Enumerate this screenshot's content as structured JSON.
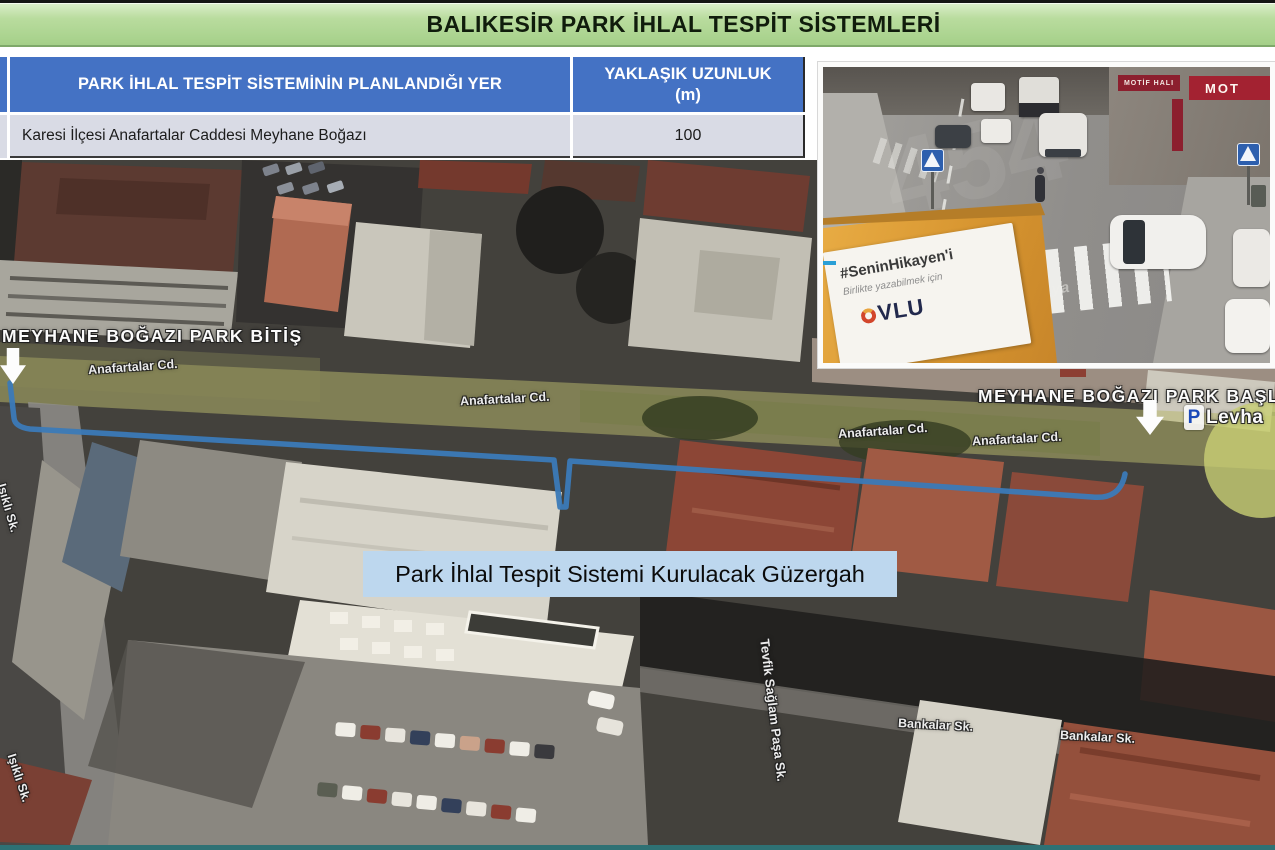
{
  "header": {
    "title": "BALIKESİR PARK İHLAL TESPİT SİSTEMLERİ"
  },
  "table": {
    "col1_header": "PARK İHLAL TESPİT SİSTEMİNİN PLANLANDIĞI YER",
    "col2_header_line1": "YAKLAŞIK UZUNLUK",
    "col2_header_line2": "(m)",
    "rows": [
      {
        "location": "Karesi İlçesi Anafartalar Caddesi Meyhane Boğazı",
        "length": "100"
      }
    ]
  },
  "camera_photo": {
    "banner_hashtag": "#SeninHikayen'i",
    "banner_tagline": "Birlikte yazabilmek için",
    "banner_logo": "VLU",
    "shop_sign_small": "MOTİF HALI",
    "shop_sign_large": "MOT",
    "road_marking": "yaya",
    "watermark": "454"
  },
  "map": {
    "label_park_end": "MEYHANE BOĞAZI PARK BİTİŞ",
    "label_park_start": "MEYHANE BOĞAZI PARK BAŞLAN",
    "label_levha": "Levha",
    "label_levha_icon": "P",
    "route_label": "Park İhlal Tespit Sistemi Kurulacak Güzergah",
    "street_anafartalar": "Anafartalar Cd.",
    "street_isikli": "Işıklı Sk.",
    "street_tevfik": "Tevfik Sağlam Paşa Sk.",
    "street_bankalar": "Bankalar Sk.",
    "colors": {
      "route_line": "#3b7ab8",
      "route_label_bg": "#bdd7ee",
      "header_green": "#b0d595",
      "table_header_blue": "#4472c4",
      "table_row_bg": "#d9dbe5"
    }
  }
}
